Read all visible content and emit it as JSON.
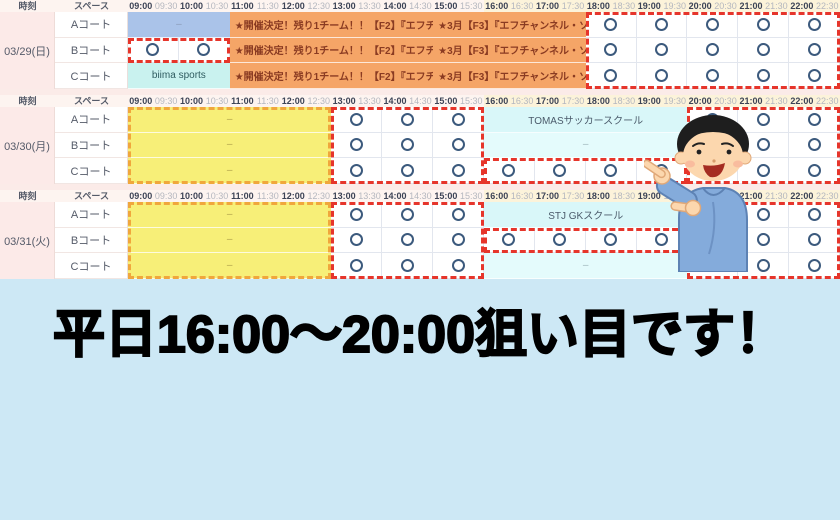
{
  "banner": {
    "text": "平日16:00〜20:00狙い目です！"
  },
  "legend": {
    "time_header": "時刻",
    "space_header": "スペース"
  },
  "time_slots": [
    "09:00",
    "09:30",
    "10:00",
    "10:30",
    "11:00",
    "11:30",
    "12:00",
    "12:30",
    "13:00",
    "13:30",
    "14:00",
    "14:30",
    "15:00",
    "15:30",
    "16:00",
    "16:30",
    "17:00",
    "17:30",
    "18:00",
    "18:30",
    "19:00",
    "19:30",
    "20:00",
    "20:30",
    "21:00",
    "21:30",
    "22:00",
    "22:30"
  ],
  "colors": {
    "board_bg": "#fbebe8",
    "header_bg": "#fdf4f0",
    "header_highlight_bg": "#fcf3da",
    "date_cell_bg": "#fceae8",
    "grid_border": "#e2e6ee",
    "hour_text": "#3c4356",
    "half_text": "#b4b7bf",
    "label_text": "#555b69",
    "circle": "#3c5a7d",
    "red_dash": "#e6352b",
    "yellow_dash": "#f0a73c",
    "orange_bg": "#f5a567",
    "orange_text": "#8a3b22",
    "blue_bg": "#aac3e9",
    "aqua_bg": "#c9f2ef",
    "cyan_bg": "#d9f7f9",
    "cyan_light_bg": "#e4fbfc",
    "yellow_bg": "#f7ef78",
    "banner_bg": "#cde8f5"
  },
  "sections": [
    {
      "date": "03/29(日)",
      "courts": [
        "Aコート",
        "Bコート",
        "Cコート"
      ],
      "header_highlight": {
        "from": 14,
        "to": 28
      },
      "rows": [
        [
          {
            "type": "blue",
            "from": 0,
            "to": 4,
            "label": "–"
          },
          {
            "type": "orange",
            "from": 4,
            "to": 12,
            "label": "★開催決定！残り1チーム！！【F2】『エフチャ…"
          },
          {
            "type": "orange",
            "from": 12,
            "to": 18,
            "label": "★3月【F3】『エフチャンネル・ソ…"
          },
          {
            "type": "open",
            "from": 18,
            "to": 28,
            "circles": [
              18,
              20,
              22,
              24,
              26
            ]
          }
        ],
        [
          {
            "type": "open",
            "from": 0,
            "to": 4,
            "circles": [
              0,
              2
            ]
          },
          {
            "type": "orange",
            "from": 4,
            "to": 12,
            "label": "★開催決定！残り1チーム！！【F2】『エフチャ…"
          },
          {
            "type": "orange",
            "from": 12,
            "to": 18,
            "label": "★3月【F3】『エフチャンネル・ソ…"
          },
          {
            "type": "open",
            "from": 18,
            "to": 28,
            "circles": [
              18,
              20,
              22,
              24,
              26
            ]
          }
        ],
        [
          {
            "type": "aqua",
            "from": 0,
            "to": 4,
            "label": "biima sports"
          },
          {
            "type": "orange",
            "from": 4,
            "to": 12,
            "label": "★開催決定！残り1チーム！！【F2】『エフチャ…"
          },
          {
            "type": "orange",
            "from": 12,
            "to": 18,
            "label": "★3月【F3】『エフチャンネル・ソ…"
          },
          {
            "type": "open",
            "from": 18,
            "to": 28,
            "circles": [
              18,
              20,
              22,
              24,
              26
            ]
          }
        ]
      ],
      "overlays": [
        {
          "color": "red",
          "row_from": 1,
          "row_to": 1,
          "from": 0,
          "to": 4
        },
        {
          "color": "red",
          "row_from": 0,
          "row_to": 2,
          "from": 18,
          "to": 28
        }
      ]
    },
    {
      "date": "03/30(月)",
      "courts": [
        "Aコート",
        "Bコート",
        "Cコート"
      ],
      "header_highlight": {
        "from": 14,
        "to": 28
      },
      "rows": [
        [
          {
            "type": "yellow",
            "from": 0,
            "to": 8,
            "label": "–"
          },
          {
            "type": "open",
            "from": 8,
            "to": 14,
            "circles": [
              8,
              10,
              12
            ]
          },
          {
            "type": "cyan",
            "from": 14,
            "to": 22,
            "label": "TOMASサッカースクール"
          },
          {
            "type": "open",
            "from": 22,
            "to": 28,
            "circles": [
              22,
              24,
              26
            ]
          }
        ],
        [
          {
            "type": "yellow",
            "from": 0,
            "to": 8,
            "label": "–"
          },
          {
            "type": "open",
            "from": 8,
            "to": 14,
            "circles": [
              8,
              10,
              12
            ]
          },
          {
            "type": "cyanlight",
            "from": 14,
            "to": 22,
            "label": "–"
          },
          {
            "type": "open",
            "from": 22,
            "to": 28,
            "circles": [
              22,
              24,
              26
            ]
          }
        ],
        [
          {
            "type": "yellow",
            "from": 0,
            "to": 8,
            "label": "–"
          },
          {
            "type": "open",
            "from": 8,
            "to": 14,
            "circles": [
              8,
              10,
              12
            ]
          },
          {
            "type": "open",
            "from": 14,
            "to": 22,
            "circles": [
              14,
              16,
              18,
              20
            ]
          },
          {
            "type": "open",
            "from": 22,
            "to": 28,
            "circles": [
              22,
              24,
              26
            ]
          }
        ]
      ],
      "overlays": [
        {
          "color": "yellow",
          "row_from": 0,
          "row_to": 2,
          "from": 0,
          "to": 8
        },
        {
          "color": "red",
          "row_from": 0,
          "row_to": 2,
          "from": 8,
          "to": 14
        },
        {
          "color": "red",
          "row_from": 2,
          "row_to": 2,
          "from": 14,
          "to": 22
        },
        {
          "color": "red",
          "row_from": 0,
          "row_to": 2,
          "from": 22,
          "to": 28
        }
      ]
    },
    {
      "date": "03/31(火)",
      "courts": [
        "Aコート",
        "Bコート",
        "Cコート"
      ],
      "header_highlight": {
        "from": 14,
        "to": 28
      },
      "rows": [
        [
          {
            "type": "yellow",
            "from": 0,
            "to": 8,
            "label": "–"
          },
          {
            "type": "open",
            "from": 8,
            "to": 14,
            "circles": [
              8,
              10,
              12
            ]
          },
          {
            "type": "cyan",
            "from": 14,
            "to": 22,
            "label": "STJ GKスクール"
          },
          {
            "type": "open",
            "from": 22,
            "to": 28,
            "circles": [
              22,
              24,
              26
            ]
          }
        ],
        [
          {
            "type": "yellow",
            "from": 0,
            "to": 8,
            "label": "–"
          },
          {
            "type": "open",
            "from": 8,
            "to": 14,
            "circles": [
              8,
              10,
              12
            ]
          },
          {
            "type": "open",
            "from": 14,
            "to": 22,
            "circles": [
              14,
              16,
              18,
              20
            ]
          },
          {
            "type": "open",
            "from": 22,
            "to": 28,
            "circles": [
              22,
              24,
              26
            ]
          }
        ],
        [
          {
            "type": "yellow",
            "from": 0,
            "to": 8,
            "label": "–"
          },
          {
            "type": "open",
            "from": 8,
            "to": 14,
            "circles": [
              8,
              10,
              12
            ]
          },
          {
            "type": "cyanlight",
            "from": 14,
            "to": 22,
            "label": "–"
          },
          {
            "type": "open",
            "from": 22,
            "to": 28,
            "circles": [
              22,
              24,
              26
            ]
          }
        ]
      ],
      "overlays": [
        {
          "color": "yellow",
          "row_from": 0,
          "row_to": 2,
          "from": 0,
          "to": 8
        },
        {
          "color": "red",
          "row_from": 0,
          "row_to": 2,
          "from": 8,
          "to": 14
        },
        {
          "color": "red",
          "row_from": 1,
          "row_to": 1,
          "from": 14,
          "to": 22
        },
        {
          "color": "red",
          "row_from": 0,
          "row_to": 2,
          "from": 22,
          "to": 28
        }
      ]
    }
  ]
}
